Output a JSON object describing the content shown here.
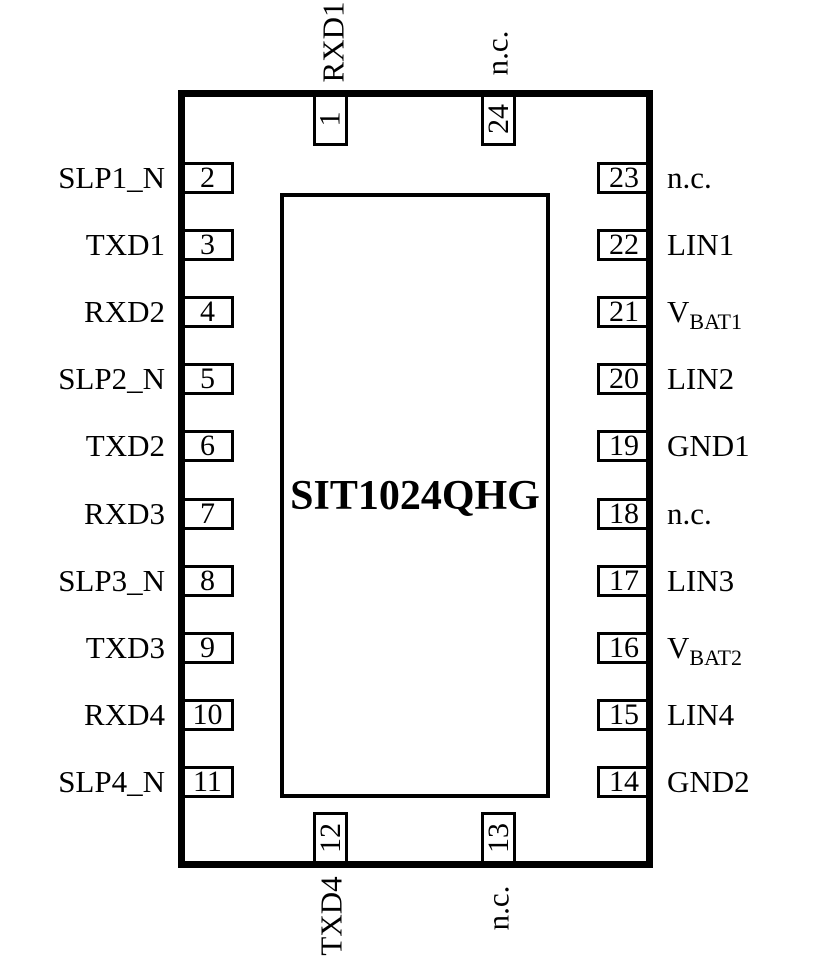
{
  "chip": {
    "title": "SIT1024QHG"
  },
  "pins": {
    "left": [
      {
        "num": "2",
        "label": "SLP1_N"
      },
      {
        "num": "3",
        "label": "TXD1"
      },
      {
        "num": "4",
        "label": "RXD2"
      },
      {
        "num": "5",
        "label": "SLP2_N"
      },
      {
        "num": "6",
        "label": "TXD2"
      },
      {
        "num": "7",
        "label": "RXD3"
      },
      {
        "num": "8",
        "label": "SLP3_N"
      },
      {
        "num": "9",
        "label": "TXD3"
      },
      {
        "num": "10",
        "label": "RXD4"
      },
      {
        "num": "11",
        "label": "SLP4_N"
      }
    ],
    "right": [
      {
        "num": "23",
        "label": "n.c."
      },
      {
        "num": "22",
        "label": "LIN1"
      },
      {
        "num": "21",
        "label": "V",
        "sub": "BAT1"
      },
      {
        "num": "20",
        "label": "LIN2"
      },
      {
        "num": "19",
        "label": "GND1"
      },
      {
        "num": "18",
        "label": "n.c."
      },
      {
        "num": "17",
        "label": "LIN3"
      },
      {
        "num": "16",
        "label": "V",
        "sub": "BAT2"
      },
      {
        "num": "15",
        "label": "LIN4"
      },
      {
        "num": "14",
        "label": "GND2"
      }
    ],
    "top": [
      {
        "num": "1",
        "label": "RXD1"
      },
      {
        "num": "24",
        "label": "n.c."
      }
    ],
    "bottom": [
      {
        "num": "12",
        "label": "TXD4"
      },
      {
        "num": "13",
        "label": "n.c."
      }
    ]
  }
}
